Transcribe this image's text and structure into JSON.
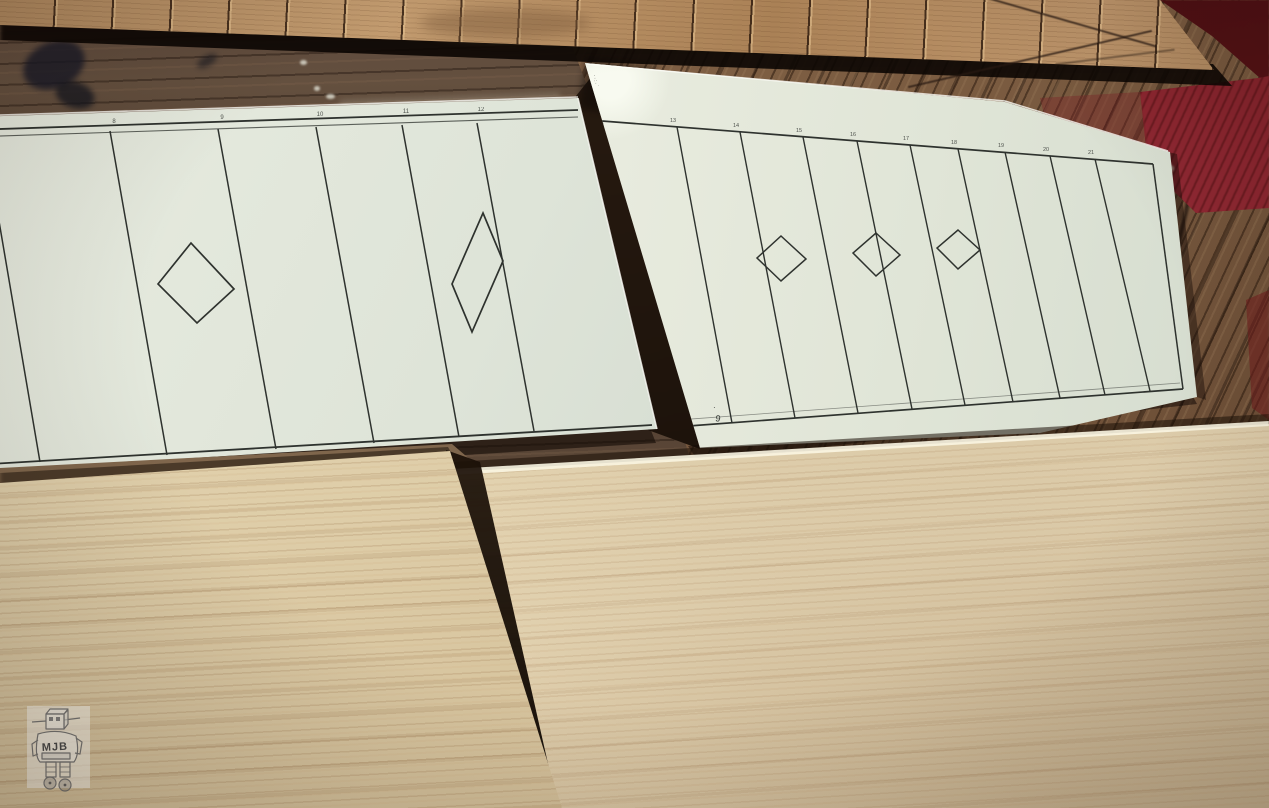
{
  "scene": {
    "type": "photograph",
    "subject": "Printed planking templates, scored cardboard strip and balsa sheets on a wooden workbench",
    "objects": [
      "scored cardboard strip",
      "left paper template",
      "right paper template",
      "balsa sheet left",
      "balsa sheet right",
      "red paint patch",
      "robot watermark"
    ]
  },
  "left_template": {
    "station_ticks": [
      "8",
      "9",
      "10",
      "11",
      "12"
    ],
    "panel_lines": 6,
    "diamonds": 2
  },
  "right_template": {
    "station_ticks": [
      "13",
      "14",
      "15",
      "16",
      "17",
      "18",
      "19",
      "20",
      "21"
    ],
    "margin_marks": "··:·˙",
    "corner_mark": "9",
    "corner_submark": "·",
    "panel_lines": 9,
    "diamonds": 3
  },
  "watermark": {
    "initials": "MJB"
  },
  "palette": {
    "paper": "#dfe4d8",
    "print_ink": "#2f332f",
    "cardboard": "#b68e63",
    "bench_dark": "#53402f",
    "bench_planks": "#7b5c41",
    "paint_red": "#8c2630",
    "balsa": "#e6d6b4",
    "shadow": "#1f140c",
    "pencil_gray": "#6a6a6a"
  }
}
